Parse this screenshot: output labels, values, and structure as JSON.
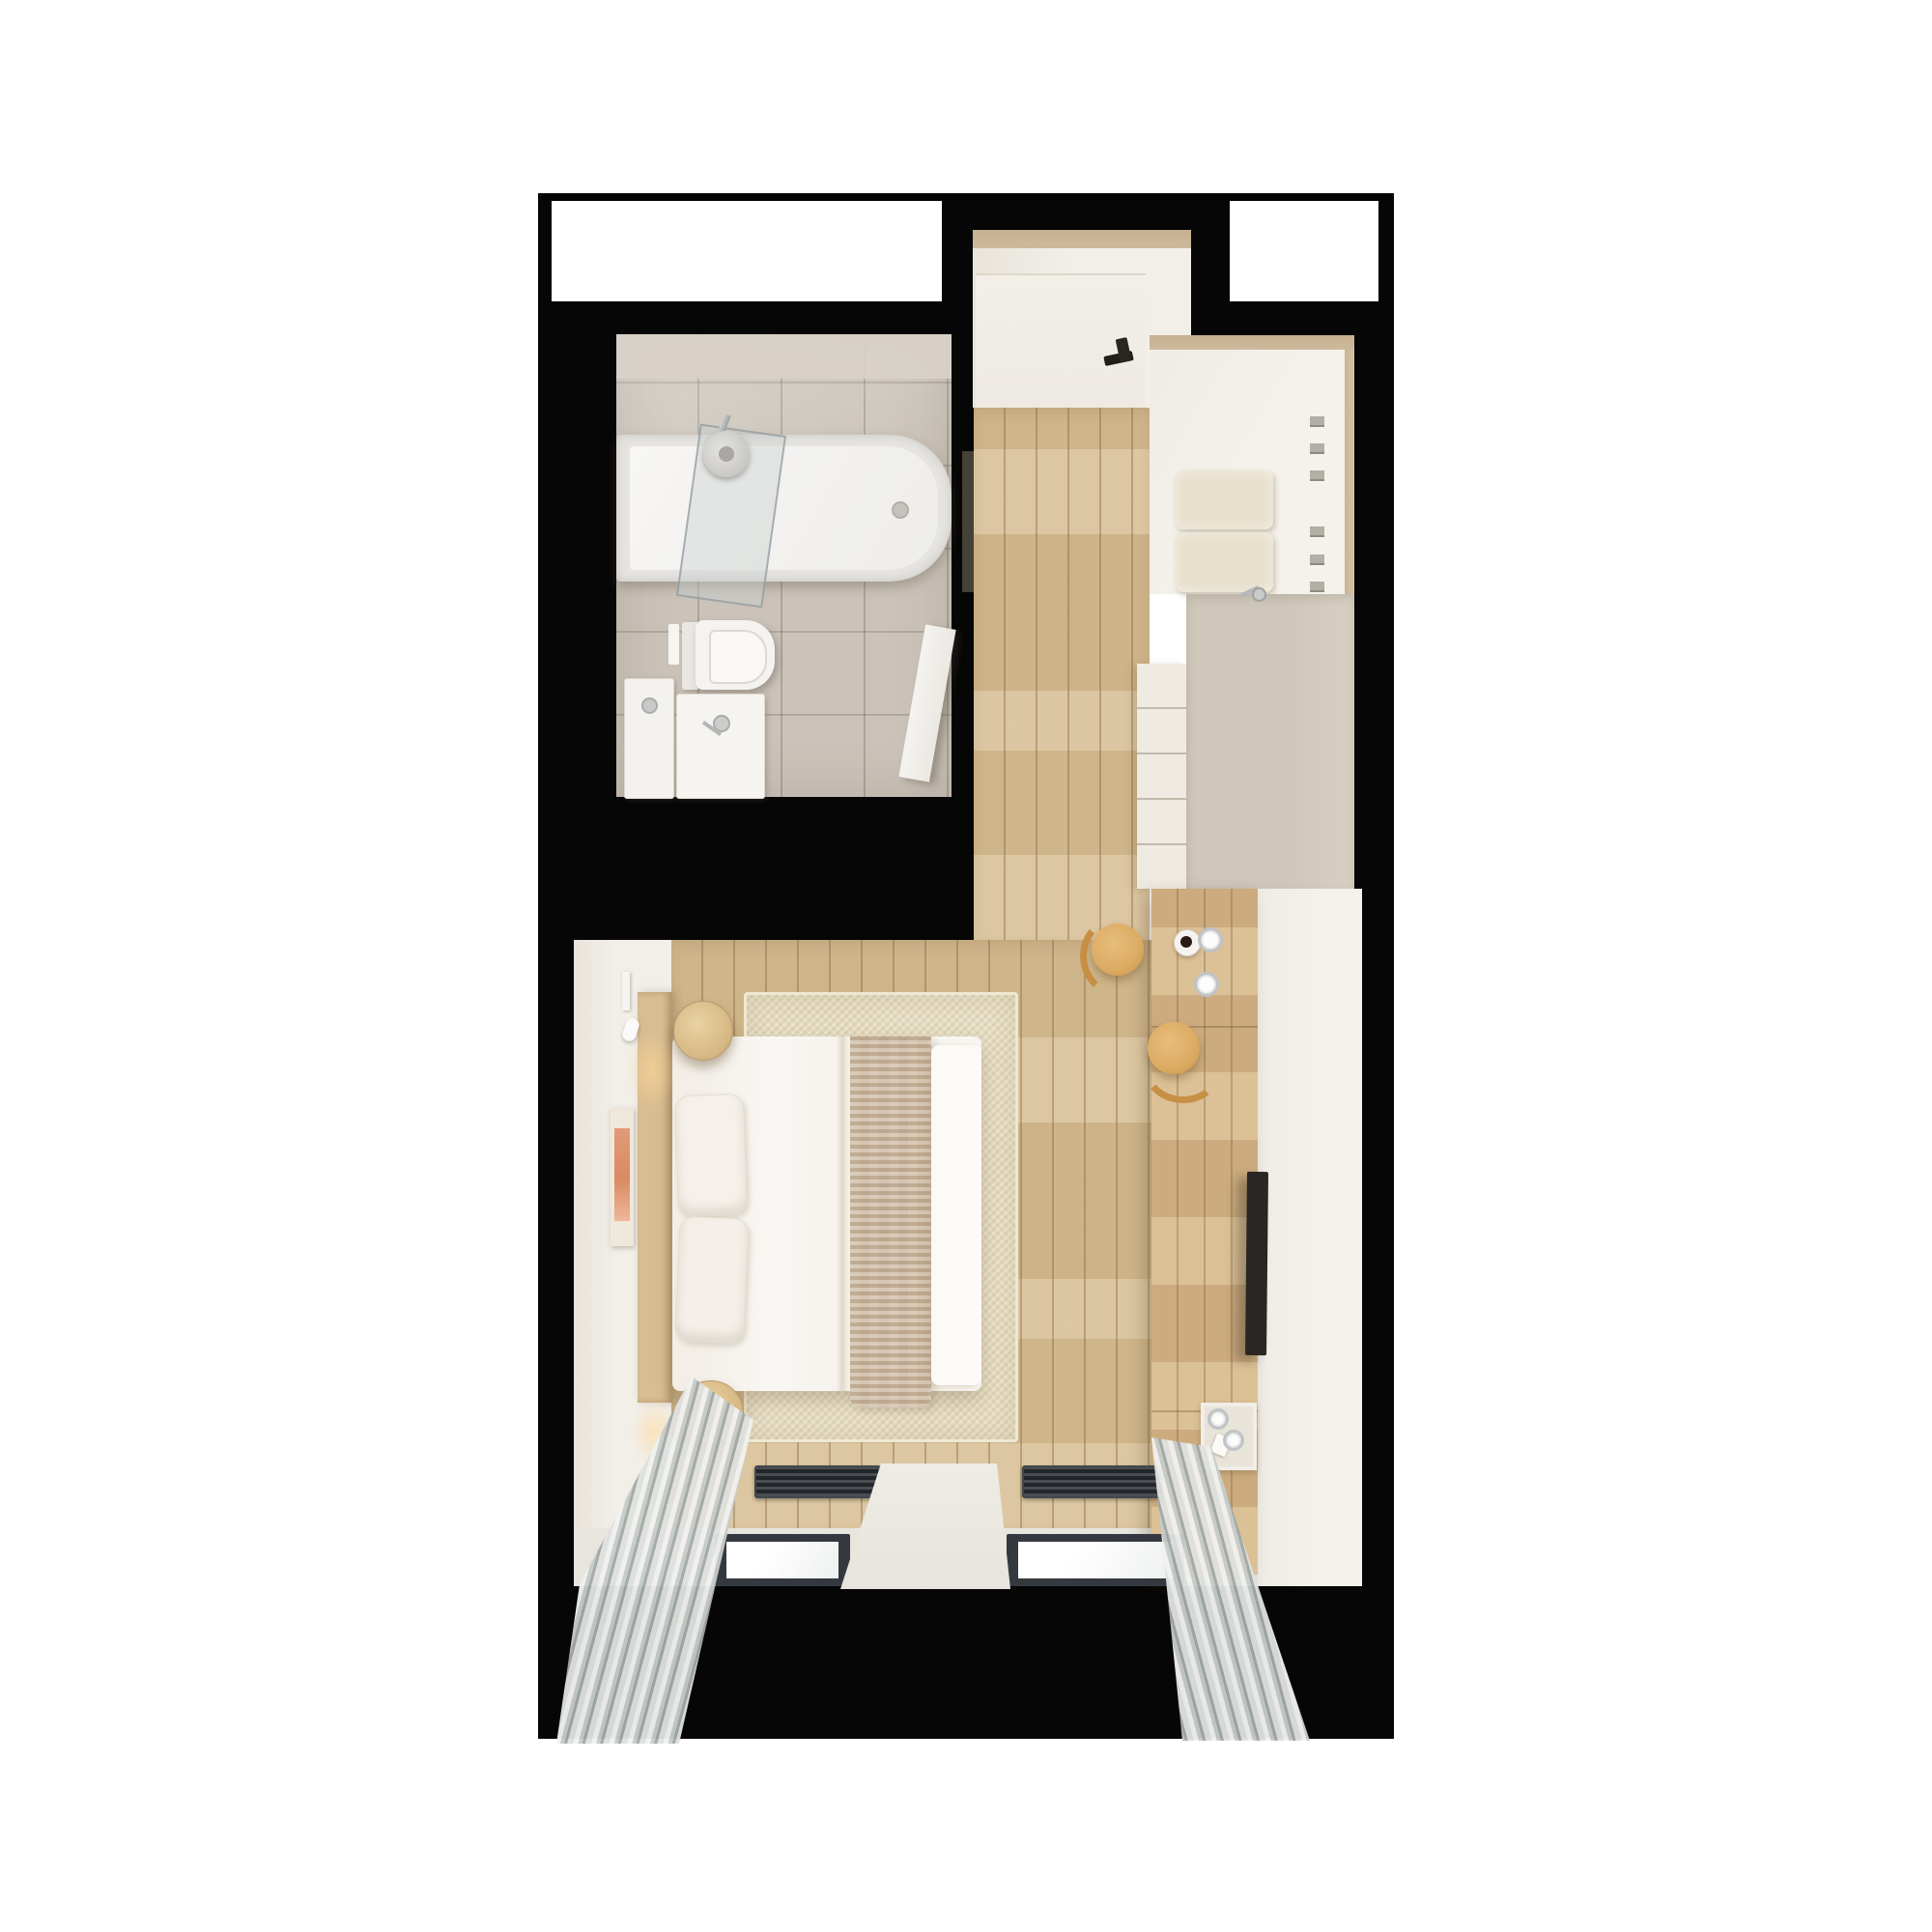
{
  "scene": {
    "title": "Top-down 3D render of a studio apartment floor plan",
    "view": "plan view, photorealistic render, no text labels",
    "background_color": "#ffffff",
    "wall_color": "#060606"
  },
  "palette": {
    "page-bg": "#ffffff",
    "wall": "#060606",
    "wood": "#d3ba90",
    "white-floor": "#f2efe9",
    "tiles": "#cbc3b9",
    "tan": "#c6b090",
    "counter": "#d2cabd",
    "cabinet-white": "#efebe3",
    "box-beige": "#e8e0cc",
    "rug": "#e6ddc2",
    "bedding": "#f8f6f2",
    "knit": "#c9b59b",
    "headboard": "#d8bd92",
    "desk-wood": "#d4b586",
    "chair-wood": "#dcab63",
    "chair-arc": "#c89045",
    "cur-a": "#f1f1ef",
    "cur-b": "#c7ccc9",
    "cur-c": "#a2a9a7",
    "frame": "#343940",
    "vent": "#22262b",
    "tv": "#292623",
    "shower-glass": "#c7d0d0",
    "artwork": "#dd9273",
    "dark-panel": "#454138"
  },
  "rooms": [
    {
      "id": "bathroom",
      "label": "Bathroom with bathtub, toilet and two basins"
    },
    {
      "id": "entry-hall",
      "label": "Entry hall with front door"
    },
    {
      "id": "corridor",
      "label": "Wood-floor corridor"
    },
    {
      "id": "wardrobe-nook",
      "label": "Wardrobe nook with storage boxes"
    },
    {
      "id": "kitchenette",
      "label": "Kitchenette counter"
    },
    {
      "id": "living-bedroom",
      "label": "Living / bedroom with double bed"
    }
  ],
  "furniture": [
    {
      "id": "bathtub",
      "label": "Bathtub with shower and glass screen"
    },
    {
      "id": "toilet",
      "label": "Wall-hung toilet"
    },
    {
      "id": "basins",
      "label": "Two white basins with chrome taps"
    },
    {
      "id": "bathroom-door",
      "label": "Open white bathroom door"
    },
    {
      "id": "entry-door",
      "label": "Entry door with dark handle"
    },
    {
      "id": "storage-boxes",
      "label": "Beige storage boxes"
    },
    {
      "id": "wardrobe-handles",
      "label": "Wardrobe drawer handles"
    },
    {
      "id": "kitchen-counter",
      "label": "Taupe kitchen counter with faucet"
    },
    {
      "id": "desk",
      "label": "Wooden desk / sideboard unit"
    },
    {
      "id": "chairs",
      "label": "Two round wooden chairs"
    },
    {
      "id": "coffee-cups",
      "label": "Coffee cup and two glasses on desk"
    },
    {
      "id": "tv",
      "label": "Flat TV on media unit"
    },
    {
      "id": "tray",
      "label": "Tray with glasses"
    },
    {
      "id": "bed",
      "label": "Double bed with white duvet and knitted throw"
    },
    {
      "id": "pillows",
      "label": "Two white pillows"
    },
    {
      "id": "nightstands",
      "label": "Two round wooden nightstands"
    },
    {
      "id": "artwork",
      "label": "Salmon-toned wall art"
    },
    {
      "id": "rug",
      "label": "Beige textured area rug"
    },
    {
      "id": "floor-vents",
      "label": "Two dark trench vents"
    },
    {
      "id": "windows",
      "label": "Two dark-framed windows"
    },
    {
      "id": "curtains",
      "label": "Two striped gray curtains"
    },
    {
      "id": "window-sheet",
      "label": "White panel between windows"
    }
  ]
}
